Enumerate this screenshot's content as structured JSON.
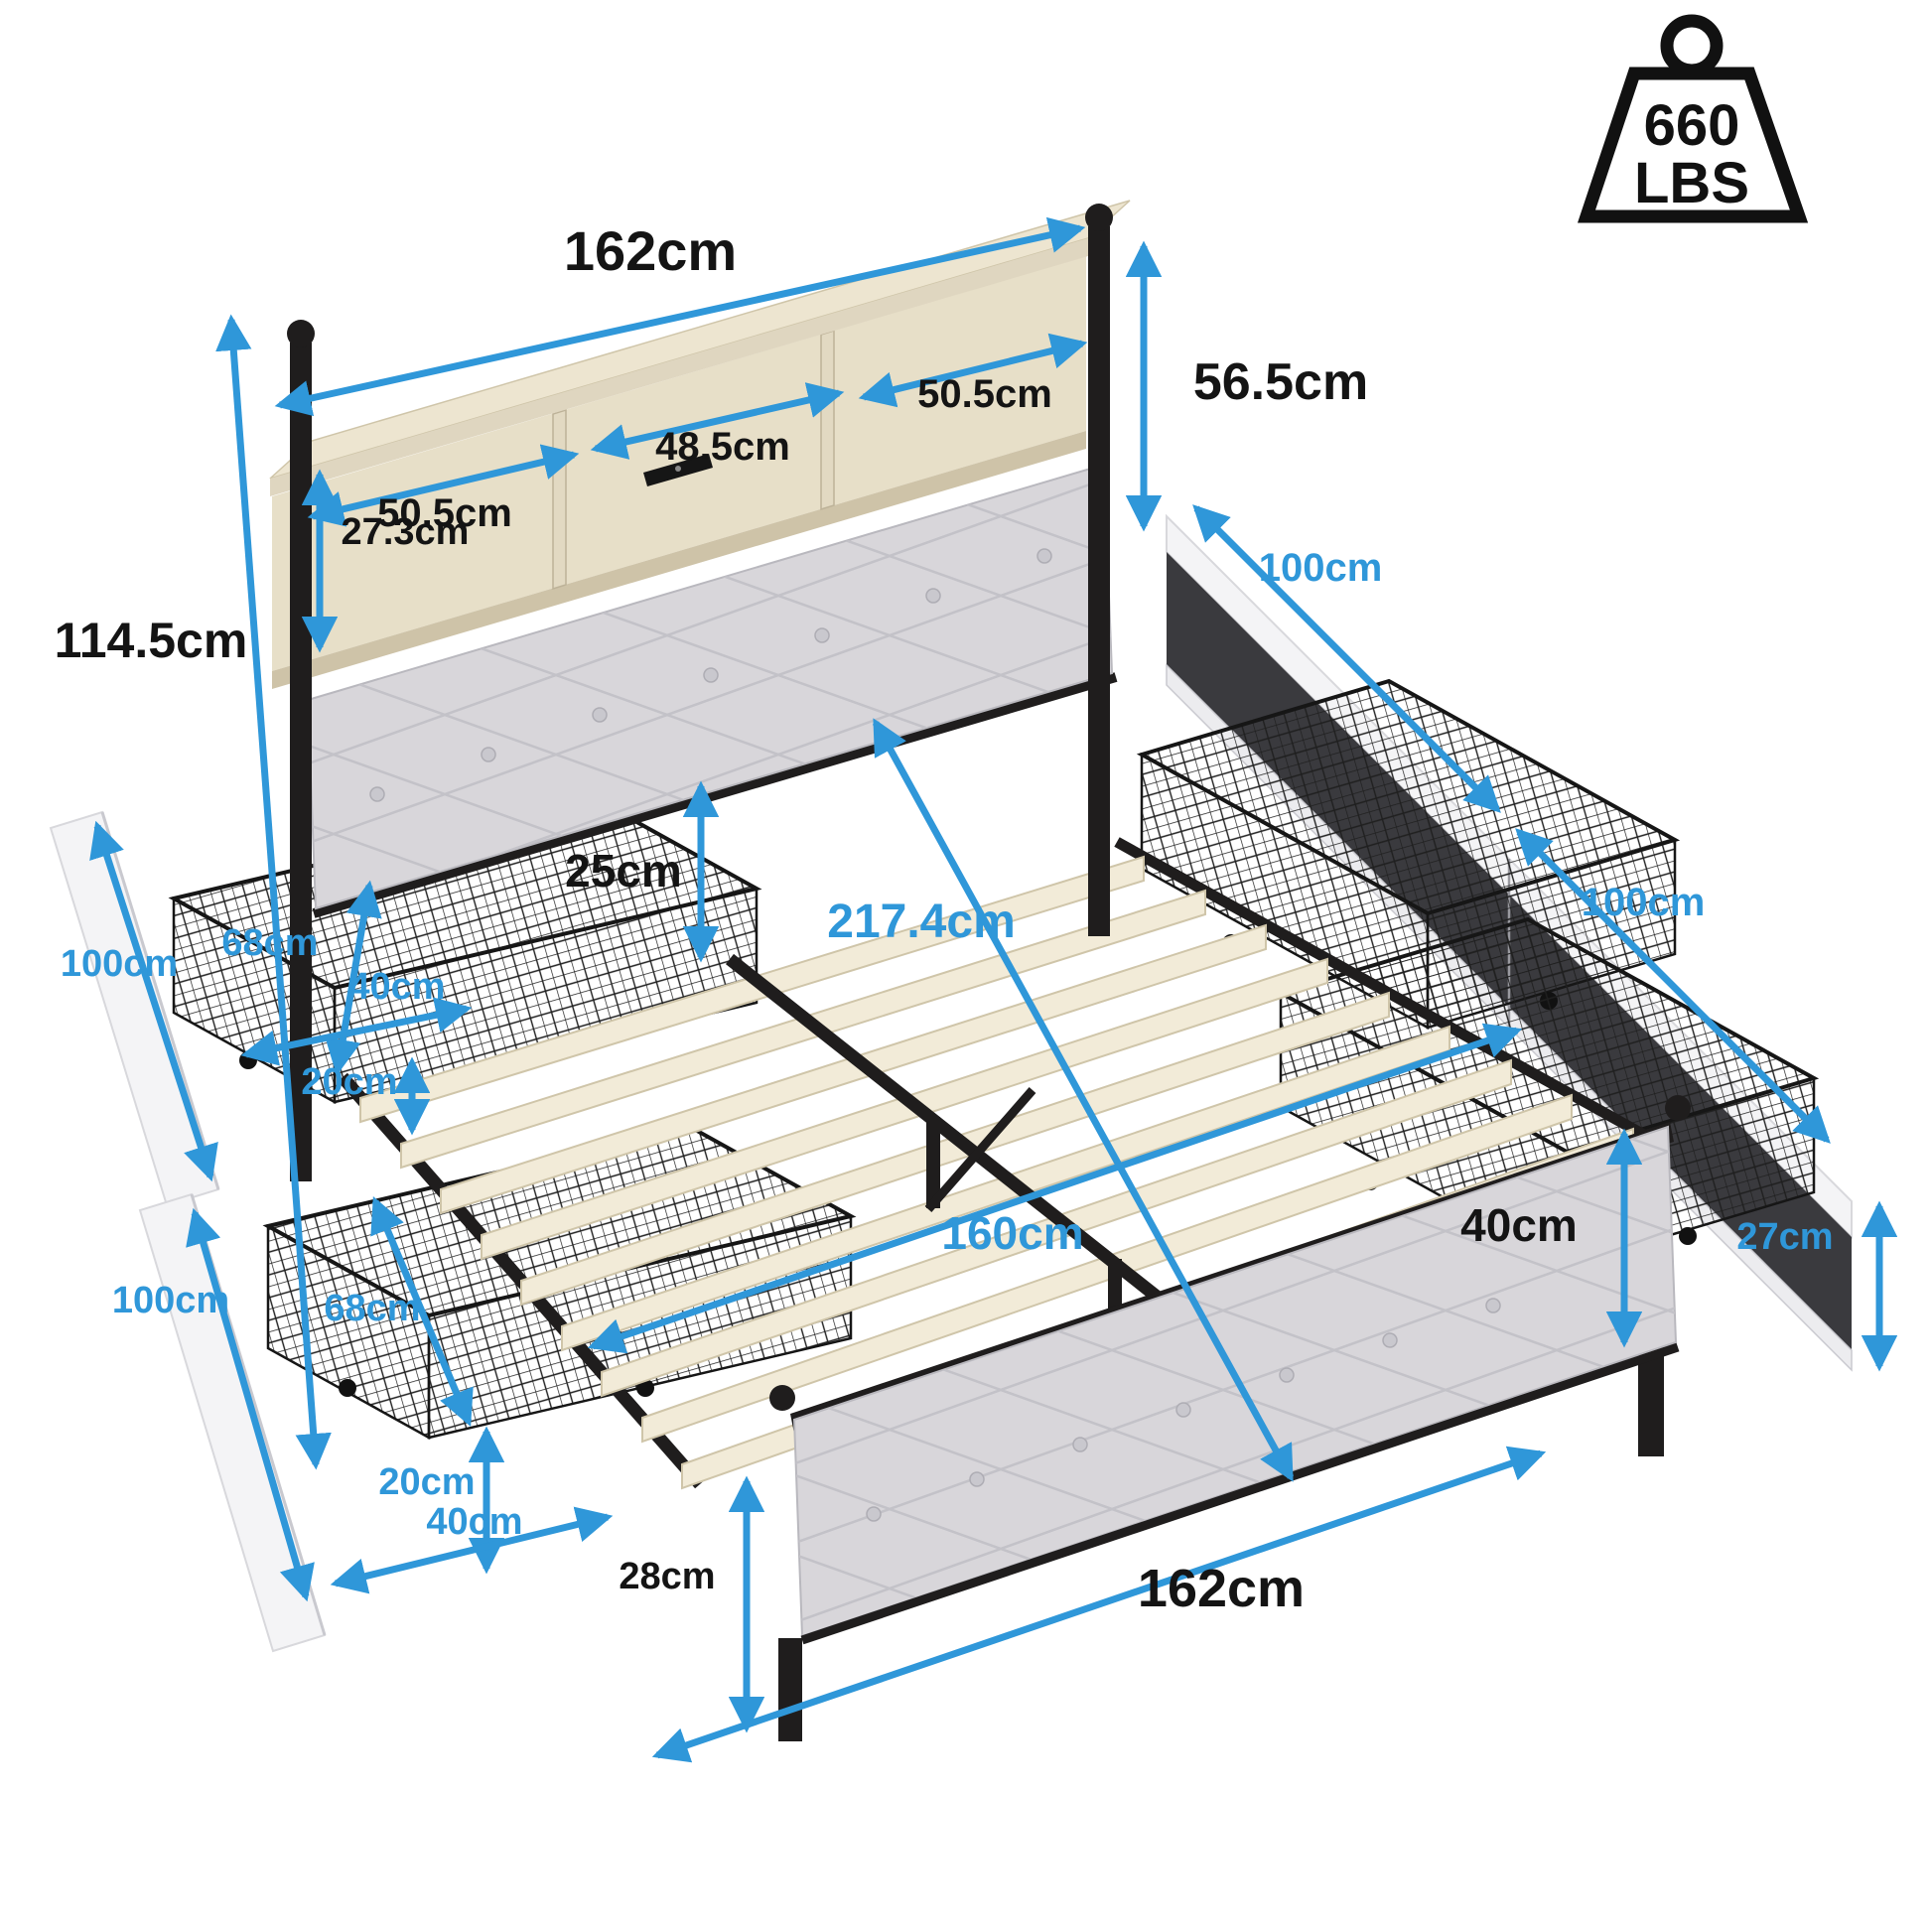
{
  "weight": {
    "value": "660",
    "unit": "LBS"
  },
  "colors": {
    "dimension_blue": "#2F97D9",
    "label_black": "#141414",
    "wood_beige": "#EDE5D0",
    "cushion_gray": "#D8D6DA",
    "metal_black": "#1f1d1d",
    "slat_cream": "#F2EBD8",
    "panel_white": "#F4F4F6"
  },
  "labels": {
    "hb_width_top": "162cm",
    "shelf_left": "50.5cm",
    "shelf_mid": "48.5cm",
    "shelf_right": "50.5cm",
    "shelf_inner_h": "27.3cm",
    "shelf_total_h": "56.5cm",
    "hb_total_h": "114.5cm",
    "gap_25": "25cm",
    "bed_diagonal": "217.4cm",
    "slat_width": "160cm",
    "right_panel_1": "100cm",
    "right_panel_2": "100cm",
    "right_panel_h": "27cm",
    "fb_height": "40cm",
    "fb_leg_h": "28cm",
    "fb_width": "162cm",
    "ul_panel": "100cm",
    "ul_depth": "68cm",
    "ul_width": "40cm",
    "ul_height": "20cm",
    "ll_panel": "100cm",
    "ll_depth": "68cm",
    "ll_height": "20cm",
    "ll_width": "40cm"
  }
}
